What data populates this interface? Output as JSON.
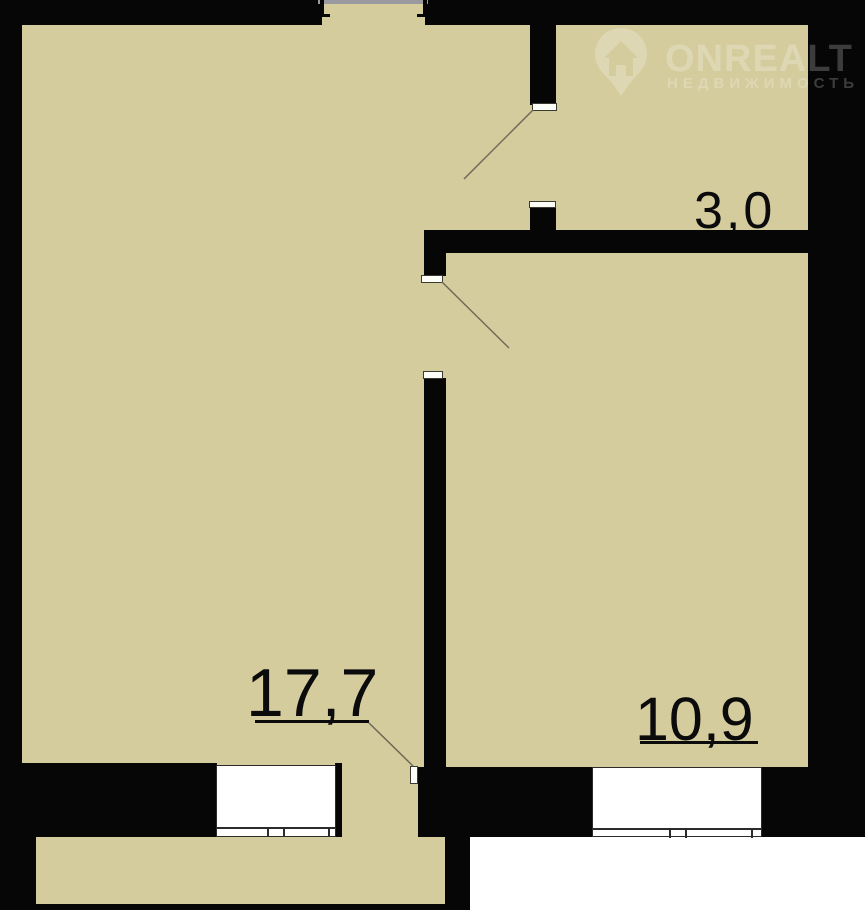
{
  "canvas": {
    "width": 865,
    "height": 910
  },
  "colors": {
    "floor": "#d5cc9e",
    "wall": "#060606",
    "frame": "#2b2b2b",
    "swing": "#6f6a57",
    "grayline": "#9a99a0",
    "label": "#0b0b0b",
    "outside": "#ffffff",
    "watermark": "rgba(255,255,255,0.22)"
  },
  "rooms": [
    {
      "label": "17,7"
    },
    {
      "label": "10,9"
    },
    {
      "label": "3,0"
    }
  ],
  "watermark": {
    "brand": "ONREALT",
    "tagline": "НЕДВИЖИМОСТЬ",
    "icon": "house-pin-icon"
  }
}
